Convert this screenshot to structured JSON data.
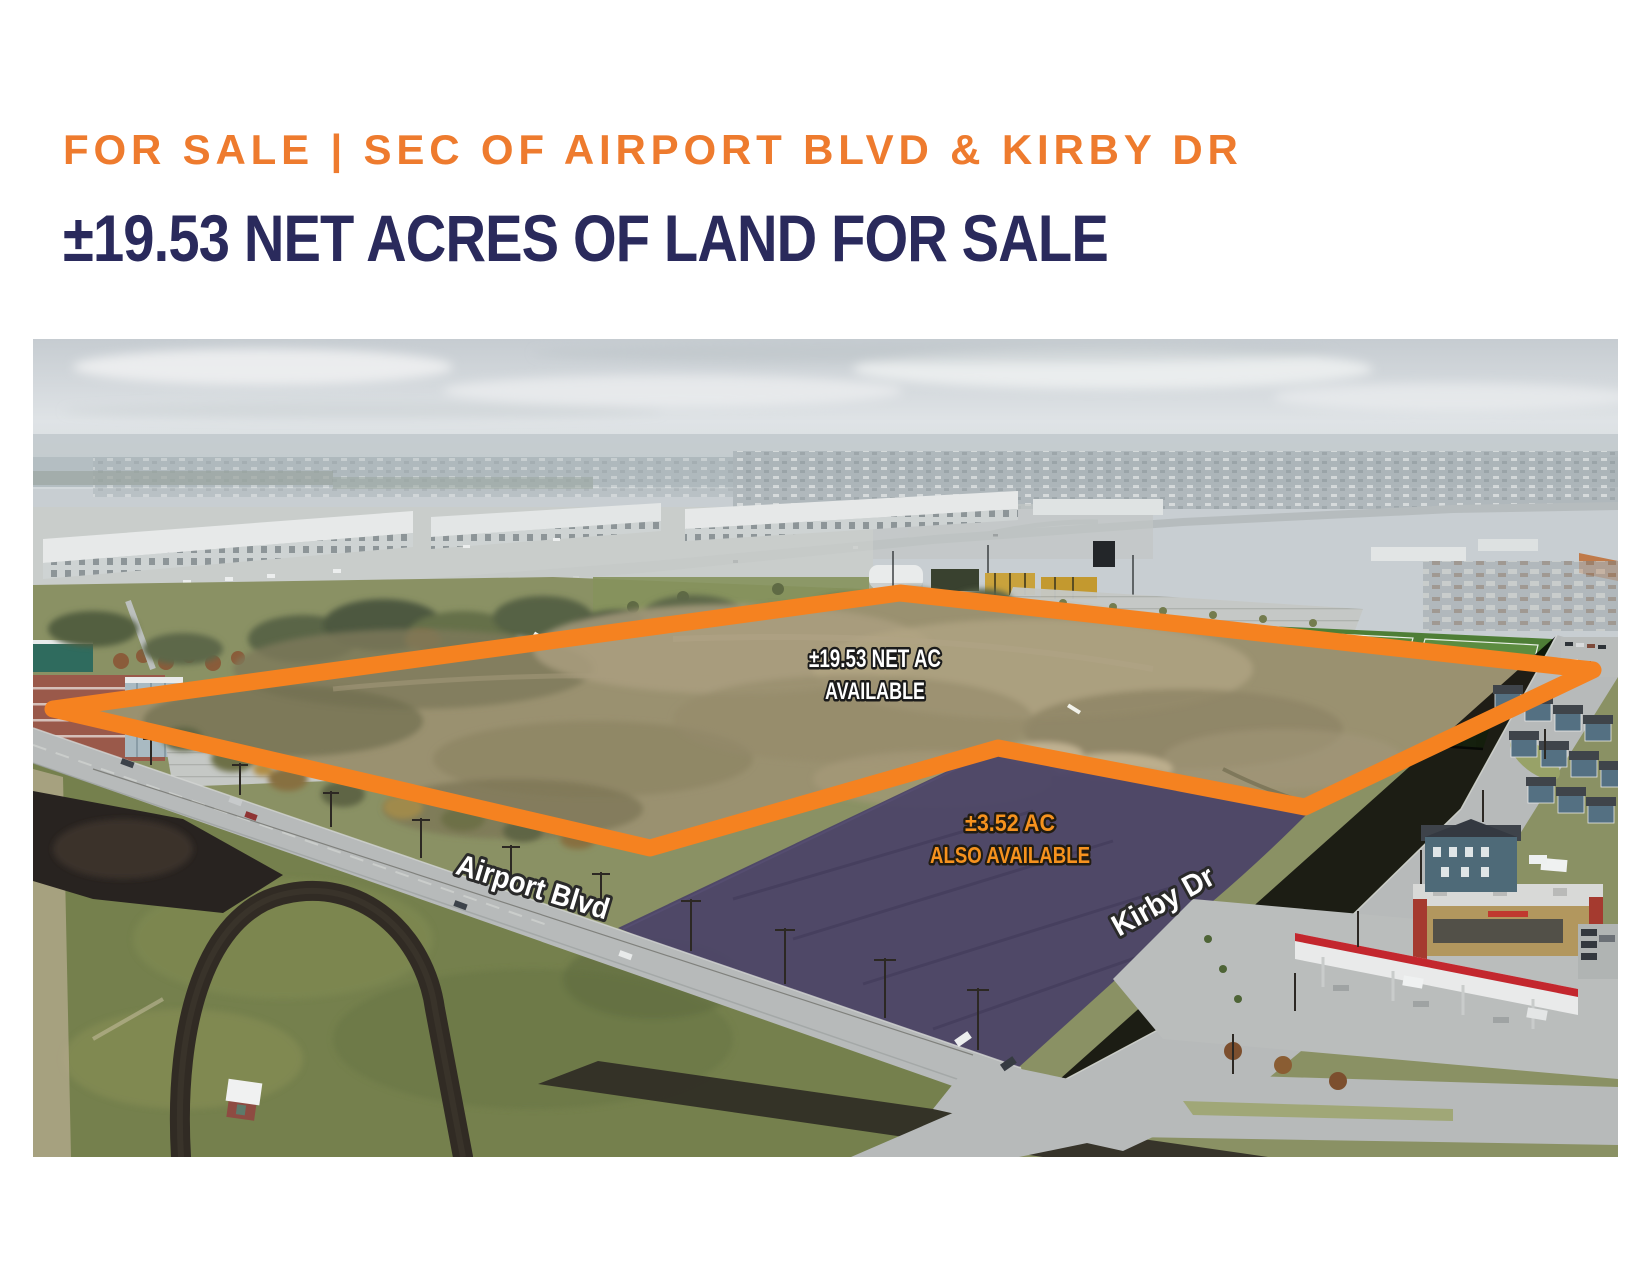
{
  "header": {
    "eyebrow": "FOR SALE | SEC OF AIRPORT BLVD & KIRBY DR",
    "title": "±19.53 NET ACRES OF LAND FOR SALE"
  },
  "photo": {
    "primary_parcel": {
      "line1": "±19.53 NET AC",
      "line2": "AVAILABLE"
    },
    "secondary_parcel": {
      "line1": "±3.52 AC",
      "line2": "ALSO AVAILABLE"
    },
    "roads": {
      "airport": "Airport Blvd",
      "kirby": "Kirby Dr"
    }
  },
  "colors": {
    "accent_orange": "#EE7B2E",
    "navy": "#2A2A5C",
    "outline_orange": "#F58220",
    "parcel_purple": "#4C4467",
    "secondary_label_orange": "#F6921E"
  }
}
